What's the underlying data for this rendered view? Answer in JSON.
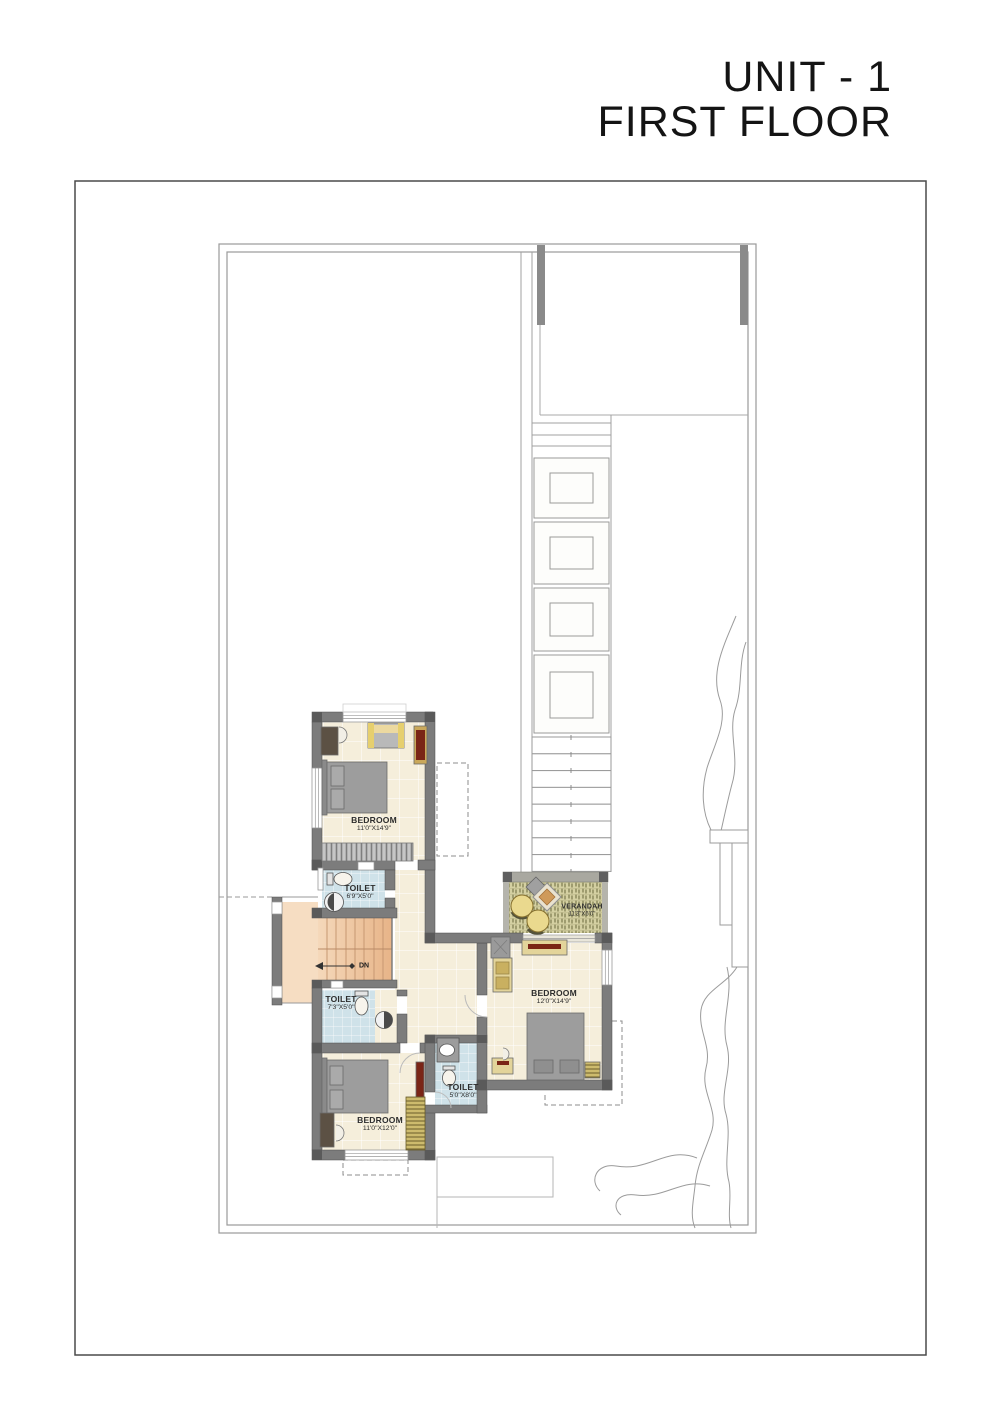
{
  "title": {
    "line1": "UNIT - 1",
    "line2": "FIRST FLOOR"
  },
  "rooms": [
    {
      "id": "bedroom-top",
      "name": "BEDROOM",
      "dims": "11'0\"X14'9\""
    },
    {
      "id": "toilet-1",
      "name": "TOILET",
      "dims": "6'9\"X5'0\""
    },
    {
      "id": "toilet-2",
      "name": "TOILET",
      "dims": "7'3\"X5'0\""
    },
    {
      "id": "bedroom-bottom",
      "name": "BEDROOM",
      "dims": "11'0\"X12'0\""
    },
    {
      "id": "toilet-3",
      "name": "TOILET",
      "dims": "5'0\"X8'0\""
    },
    {
      "id": "bedroom-right",
      "name": "BEDROOM",
      "dims": "12'0\"X14'9\""
    },
    {
      "id": "verandah",
      "name": "VERANDAH",
      "dims": "11'3\"X6'0\""
    }
  ],
  "stairs": {
    "dn": "DN"
  },
  "colors": {
    "wall": "#7c7c7c",
    "wall_dark": "#5a5a5a",
    "floor_cream": "#f5eedb",
    "tile_blue": "#cfe2e9",
    "stair_peach": "#eec49e",
    "stair_landing": "#f6ddc2",
    "verandah_green": "#d4d0a2",
    "furniture_gray": "#9d9d9d",
    "wood_tan": "#e3d49a",
    "accent_maroon": "#7a2516",
    "accent_yellow": "#e6cf6e",
    "line_gray": "#9a9a9a"
  }
}
